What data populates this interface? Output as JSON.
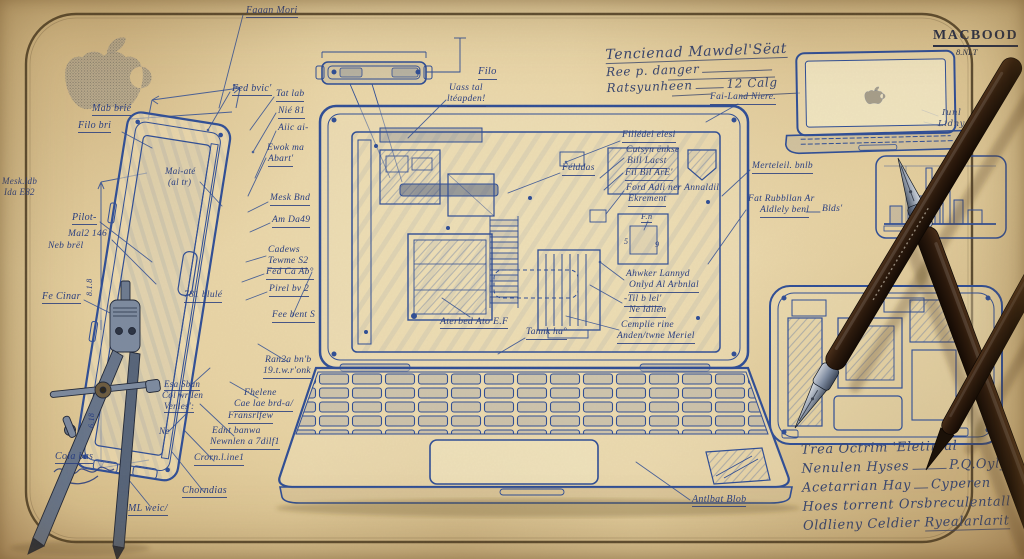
{
  "header": {
    "brand": "MACBOOD",
    "brand_sub": "8.NLT",
    "note1": "Tencienad Mawdel'Sëat",
    "note2": "Ree p. danger",
    "note3": "Ratsyunheen",
    "note3_value": "12 Calg"
  },
  "footer_note": {
    "line1": "Trea Octrim 'Eletinlal",
    "line2_label": "Nenulen Hyses",
    "line2_value": "P.Q.Oyly",
    "line3_label": "Acetarrian Hay",
    "line3_value": "Cyperen",
    "line4": "Hoes torrent Orsbreculentall",
    "line5_label": "Oldlieny Celdier",
    "line5_value": "Ryealarlarit"
  },
  "colors": {
    "ink": "#2c4a94",
    "paper": "#e7d3a4",
    "frame": "#43351f",
    "pen_wood": "#2e1c0e",
    "steel": "#7e8ba0"
  },
  "icons": {
    "apple_logo": "apple-logo",
    "compass": "drafting-compass",
    "pens": "fountain-pens"
  },
  "labels": [
    {
      "t": "Faaan Mori",
      "x": 246,
      "y": 6,
      "s": 10,
      "u": 1
    },
    {
      "t": "Fed bvic'",
      "x": 232,
      "y": 84,
      "s": 10,
      "u": 1
    },
    {
      "t": "Tat lab",
      "x": 276,
      "y": 90,
      "s": 9.5,
      "u": 1
    },
    {
      "t": "Nié 81",
      "x": 278,
      "y": 107,
      "s": 9.5,
      "u": 1
    },
    {
      "t": "Aiic ai-",
      "x": 278,
      "y": 124,
      "s": 9.5
    },
    {
      "t": "Ewok ma",
      "x": 267,
      "y": 144,
      "s": 9.5
    },
    {
      "t": "Abart'",
      "x": 268,
      "y": 155,
      "s": 9.5,
      "u": 1
    },
    {
      "t": "Mab brié",
      "x": 92,
      "y": 104,
      "s": 10,
      "u": 1
    },
    {
      "t": "Filo bri",
      "x": 78,
      "y": 121,
      "s": 10,
      "u": 1
    },
    {
      "t": "Mai-até",
      "x": 165,
      "y": 167,
      "s": 9
    },
    {
      "t": "(al tr)",
      "x": 168,
      "y": 178,
      "s": 9
    },
    {
      "t": "Mesk.ldb",
      "x": 2,
      "y": 177,
      "s": 9
    },
    {
      "t": "Ida E82",
      "x": 4,
      "y": 188,
      "s": 9
    },
    {
      "t": "Pilot-",
      "x": 72,
      "y": 213,
      "s": 10,
      "u": 1
    },
    {
      "t": "Mal2 146",
      "x": 68,
      "y": 230,
      "s": 9.5
    },
    {
      "t": "Neb brël",
      "x": 48,
      "y": 242,
      "s": 9.5
    },
    {
      "t": "Fe Cinar",
      "x": 42,
      "y": 292,
      "s": 10,
      "u": 1
    },
    {
      "t": "8.1.8",
      "x": 86,
      "y": 296,
      "s": 8,
      "r": -90
    },
    {
      "t": "6.18",
      "x": 88,
      "y": 428,
      "s": 8,
      "r": -90
    },
    {
      "t": "Cola bas",
      "x": 55,
      "y": 452,
      "s": 10,
      "u": 1
    },
    {
      "t": "ML weic/",
      "x": 128,
      "y": 504,
      "s": 10,
      "u": 1
    },
    {
      "t": "Chorndias",
      "x": 182,
      "y": 486,
      "s": 10,
      "u": 1
    },
    {
      "t": "Crorn.l.ine1",
      "x": 194,
      "y": 454,
      "s": 9.5,
      "u": 1
    },
    {
      "t": "Ednt banwa",
      "x": 212,
      "y": 427,
      "s": 9.5
    },
    {
      "t": "Newnlen a 7dilf1",
      "x": 210,
      "y": 438,
      "s": 9.5,
      "u": 1
    },
    {
      "t": "Fhelene",
      "x": 244,
      "y": 389,
      "s": 9.5
    },
    {
      "t": "Cae lae brd-a/",
      "x": 234,
      "y": 400,
      "s": 9.5,
      "u": 1
    },
    {
      "t": "Fransrlfew",
      "x": 228,
      "y": 412,
      "s": 9.5,
      "u": 1
    },
    {
      "t": "Esa Sbun",
      "x": 164,
      "y": 380,
      "s": 9,
      "u": 1
    },
    {
      "t": "Col wr'Ien",
      "x": 162,
      "y": 391,
      "s": 9
    },
    {
      "t": "Venles':",
      "x": 164,
      "y": 402,
      "s": 9,
      "u": 1
    },
    {
      "t": "Ne",
      "x": 159,
      "y": 427,
      "s": 9
    },
    {
      "t": "Ran2a bn'b",
      "x": 265,
      "y": 356,
      "s": 9.5
    },
    {
      "t": "19.t.w.r'onk",
      "x": 263,
      "y": 367,
      "s": 9.5,
      "u": 1
    },
    {
      "t": "781 blulé",
      "x": 184,
      "y": 291,
      "s": 9.5,
      "u": 1
    },
    {
      "t": "Cadews",
      "x": 268,
      "y": 246,
      "s": 9.5
    },
    {
      "t": "Tewme S2",
      "x": 268,
      "y": 257,
      "s": 9.5,
      "u": 1
    },
    {
      "t": "Fed Ca Ab°",
      "x": 266,
      "y": 268,
      "s": 9.5,
      "u": 1
    },
    {
      "t": "Pirel bv 2",
      "x": 269,
      "y": 285,
      "s": 9.5,
      "u": 1
    },
    {
      "t": "Fee bent S",
      "x": 272,
      "y": 311,
      "s": 9.5,
      "u": 1
    },
    {
      "t": "Mesk Bnd",
      "x": 270,
      "y": 194,
      "s": 9.5,
      "u": 1
    },
    {
      "t": "Am Da49",
      "x": 272,
      "y": 216,
      "s": 9.5,
      "u": 1
    },
    {
      "t": "Filo",
      "x": 478,
      "y": 67,
      "s": 10.5,
      "u": 1
    },
    {
      "t": "Uass tal",
      "x": 449,
      "y": 84,
      "s": 9.5
    },
    {
      "t": "ltéapden!",
      "x": 447,
      "y": 95,
      "s": 9.5,
      "u": 1
    },
    {
      "t": "Fai-Land Niere.",
      "x": 710,
      "y": 93,
      "s": 9.5,
      "u": 1
    },
    {
      "t": "Fillédel elesi",
      "x": 622,
      "y": 131,
      "s": 9.5,
      "u": 1
    },
    {
      "t": "Cutsyn ënkse",
      "x": 626,
      "y": 146,
      "s": 9.5
    },
    {
      "t": "Bill Lacst",
      "x": 627,
      "y": 157,
      "s": 9.5,
      "u": 1
    },
    {
      "t": "Fil Bil ArE'",
      "x": 625,
      "y": 169,
      "s": 9.5,
      "u": 1
    },
    {
      "t": "Ford Adli ner Annaldil",
      "x": 626,
      "y": 184,
      "s": 9.5
    },
    {
      "t": "Ekrement",
      "x": 628,
      "y": 195,
      "s": 9.5,
      "u": 1
    },
    {
      "t": "F.n",
      "x": 641,
      "y": 212,
      "s": 8.5,
      "u": 1
    },
    {
      "t": "Félddas",
      "x": 562,
      "y": 164,
      "s": 9.5,
      "u": 1
    },
    {
      "t": "5",
      "x": 624,
      "y": 238,
      "s": 8
    },
    {
      "t": "9",
      "x": 655,
      "y": 241,
      "s": 8
    },
    {
      "t": "Ahwker Lannyd",
      "x": 626,
      "y": 270,
      "s": 9.5
    },
    {
      "t": "Onlyd Al Arbnlal",
      "x": 629,
      "y": 281,
      "s": 9.5,
      "u": 1
    },
    {
      "t": "-Til b lel'",
      "x": 624,
      "y": 295,
      "s": 9.5,
      "u": 1
    },
    {
      "t": "Ne ldilen",
      "x": 629,
      "y": 306,
      "s": 9.5,
      "u": 1
    },
    {
      "t": "Cemplie rine",
      "x": 621,
      "y": 321,
      "s": 9.5
    },
    {
      "t": "Anden/twne Meriel",
      "x": 617,
      "y": 332,
      "s": 9.5,
      "u": 1
    },
    {
      "t": "Aterbed Ato E.F",
      "x": 440,
      "y": 317,
      "s": 9.8,
      "u": 1
    },
    {
      "t": "Tannk ha°",
      "x": 526,
      "y": 328,
      "s": 9.5,
      "u": 1
    },
    {
      "t": "Antlbat Blob",
      "x": 692,
      "y": 495,
      "s": 10,
      "u": 1
    },
    {
      "t": "Merteleil. bnlb",
      "x": 752,
      "y": 162,
      "s": 9.5,
      "u": 1
    },
    {
      "t": "Fat Rubbllan Ar",
      "x": 748,
      "y": 195,
      "s": 9.5
    },
    {
      "t": "Aldlely benl",
      "x": 760,
      "y": 206,
      "s": 9.5,
      "u": 1
    },
    {
      "t": "Blds'",
      "x": 822,
      "y": 205,
      "s": 9.5
    },
    {
      "t": "Iunl",
      "x": 942,
      "y": 109,
      "s": 8.5,
      "cls": "script"
    },
    {
      "t": "Lidny 2",
      "x": 938,
      "y": 120,
      "s": 8.5,
      "cls": "script"
    }
  ]
}
